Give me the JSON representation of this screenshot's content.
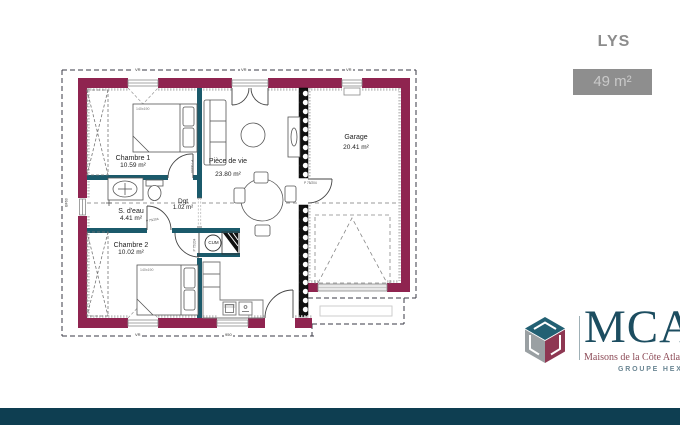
{
  "header": {
    "title": "LYS",
    "area": "49 m²"
  },
  "plan": {
    "rooms": [
      {
        "id": "chambre1",
        "name": "Chambre 1",
        "area": "10.59 m²"
      },
      {
        "id": "sdeau",
        "name": "S. d'eau",
        "area": "4.41 m²"
      },
      {
        "id": "dgt",
        "name": "Dgt",
        "area": "1.02 m²"
      },
      {
        "id": "chambre2",
        "name": "Chambre 2",
        "area": "10.02 m²"
      },
      {
        "id": "piece_de_vie",
        "name": "Pièce de vie",
        "area": "23.80 m²"
      },
      {
        "id": "garage",
        "name": "Garage",
        "area": "20.41 m²"
      }
    ],
    "labels": {
      "water_heater": "CUM",
      "bed_size": "140x190",
      "door": "P 75/204",
      "shutter": "VR",
      "window_left": "BF60",
      "dim_bottom": "950"
    },
    "colors": {
      "exterior_wall": "#8f2450",
      "interior_wall": "#1b5a6b",
      "footer_bar": "#0e3e51"
    }
  },
  "branding": {
    "logo_text": "MCA",
    "tagline": "Maisons de la Côte Atlantique",
    "group": "GROUPE HEXAOM"
  }
}
